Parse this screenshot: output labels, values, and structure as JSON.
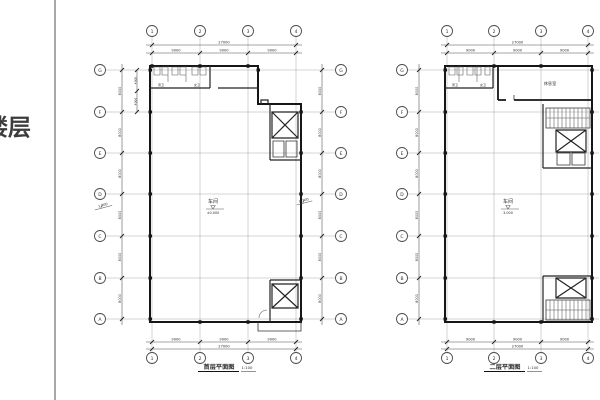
{
  "side_panel": {
    "label": "楼层"
  },
  "drawing": {
    "plans": [
      {
        "title": "首层平面图",
        "scale": "1:100",
        "cols": [
          "1",
          "2",
          "3",
          "4"
        ],
        "rows": [
          "G",
          "F",
          "E",
          "D",
          "C",
          "B",
          "A"
        ],
        "top_total": "27000",
        "top_segs": [
          "9000",
          "9000",
          "9000"
        ],
        "bottom_total": "27000",
        "bottom_segs": [
          "9000",
          "9000",
          "9000"
        ],
        "side_segs": [
          "8000",
          "8000",
          "8000",
          "8000",
          "8000",
          "8000"
        ],
        "sub_segs": [
          "4000",
          "4000"
        ],
        "room_label": "车间",
        "level": "±0.000",
        "left_level": "1.000",
        "right_level": "0.300",
        "wc_labels": [
          "男卫",
          "女卫"
        ]
      },
      {
        "title": "二层平面图",
        "scale": "1:100",
        "cols": [
          "1",
          "2",
          "3",
          "4"
        ],
        "rows": [
          "G",
          "F",
          "E",
          "D",
          "C",
          "B",
          "A"
        ],
        "top_total": "27000",
        "top_segs": [
          "9000",
          "9000",
          "9000"
        ],
        "bottom_total": "27000",
        "bottom_segs": [
          "9000",
          "9000",
          "9000"
        ],
        "side_segs": [
          "8000",
          "8000",
          "8000",
          "8000",
          "8000",
          "8000"
        ],
        "room_label": "车间",
        "level": "3.000",
        "top_room": "休息室",
        "wc_labels": [
          "男卫",
          "女卫"
        ]
      }
    ]
  }
}
